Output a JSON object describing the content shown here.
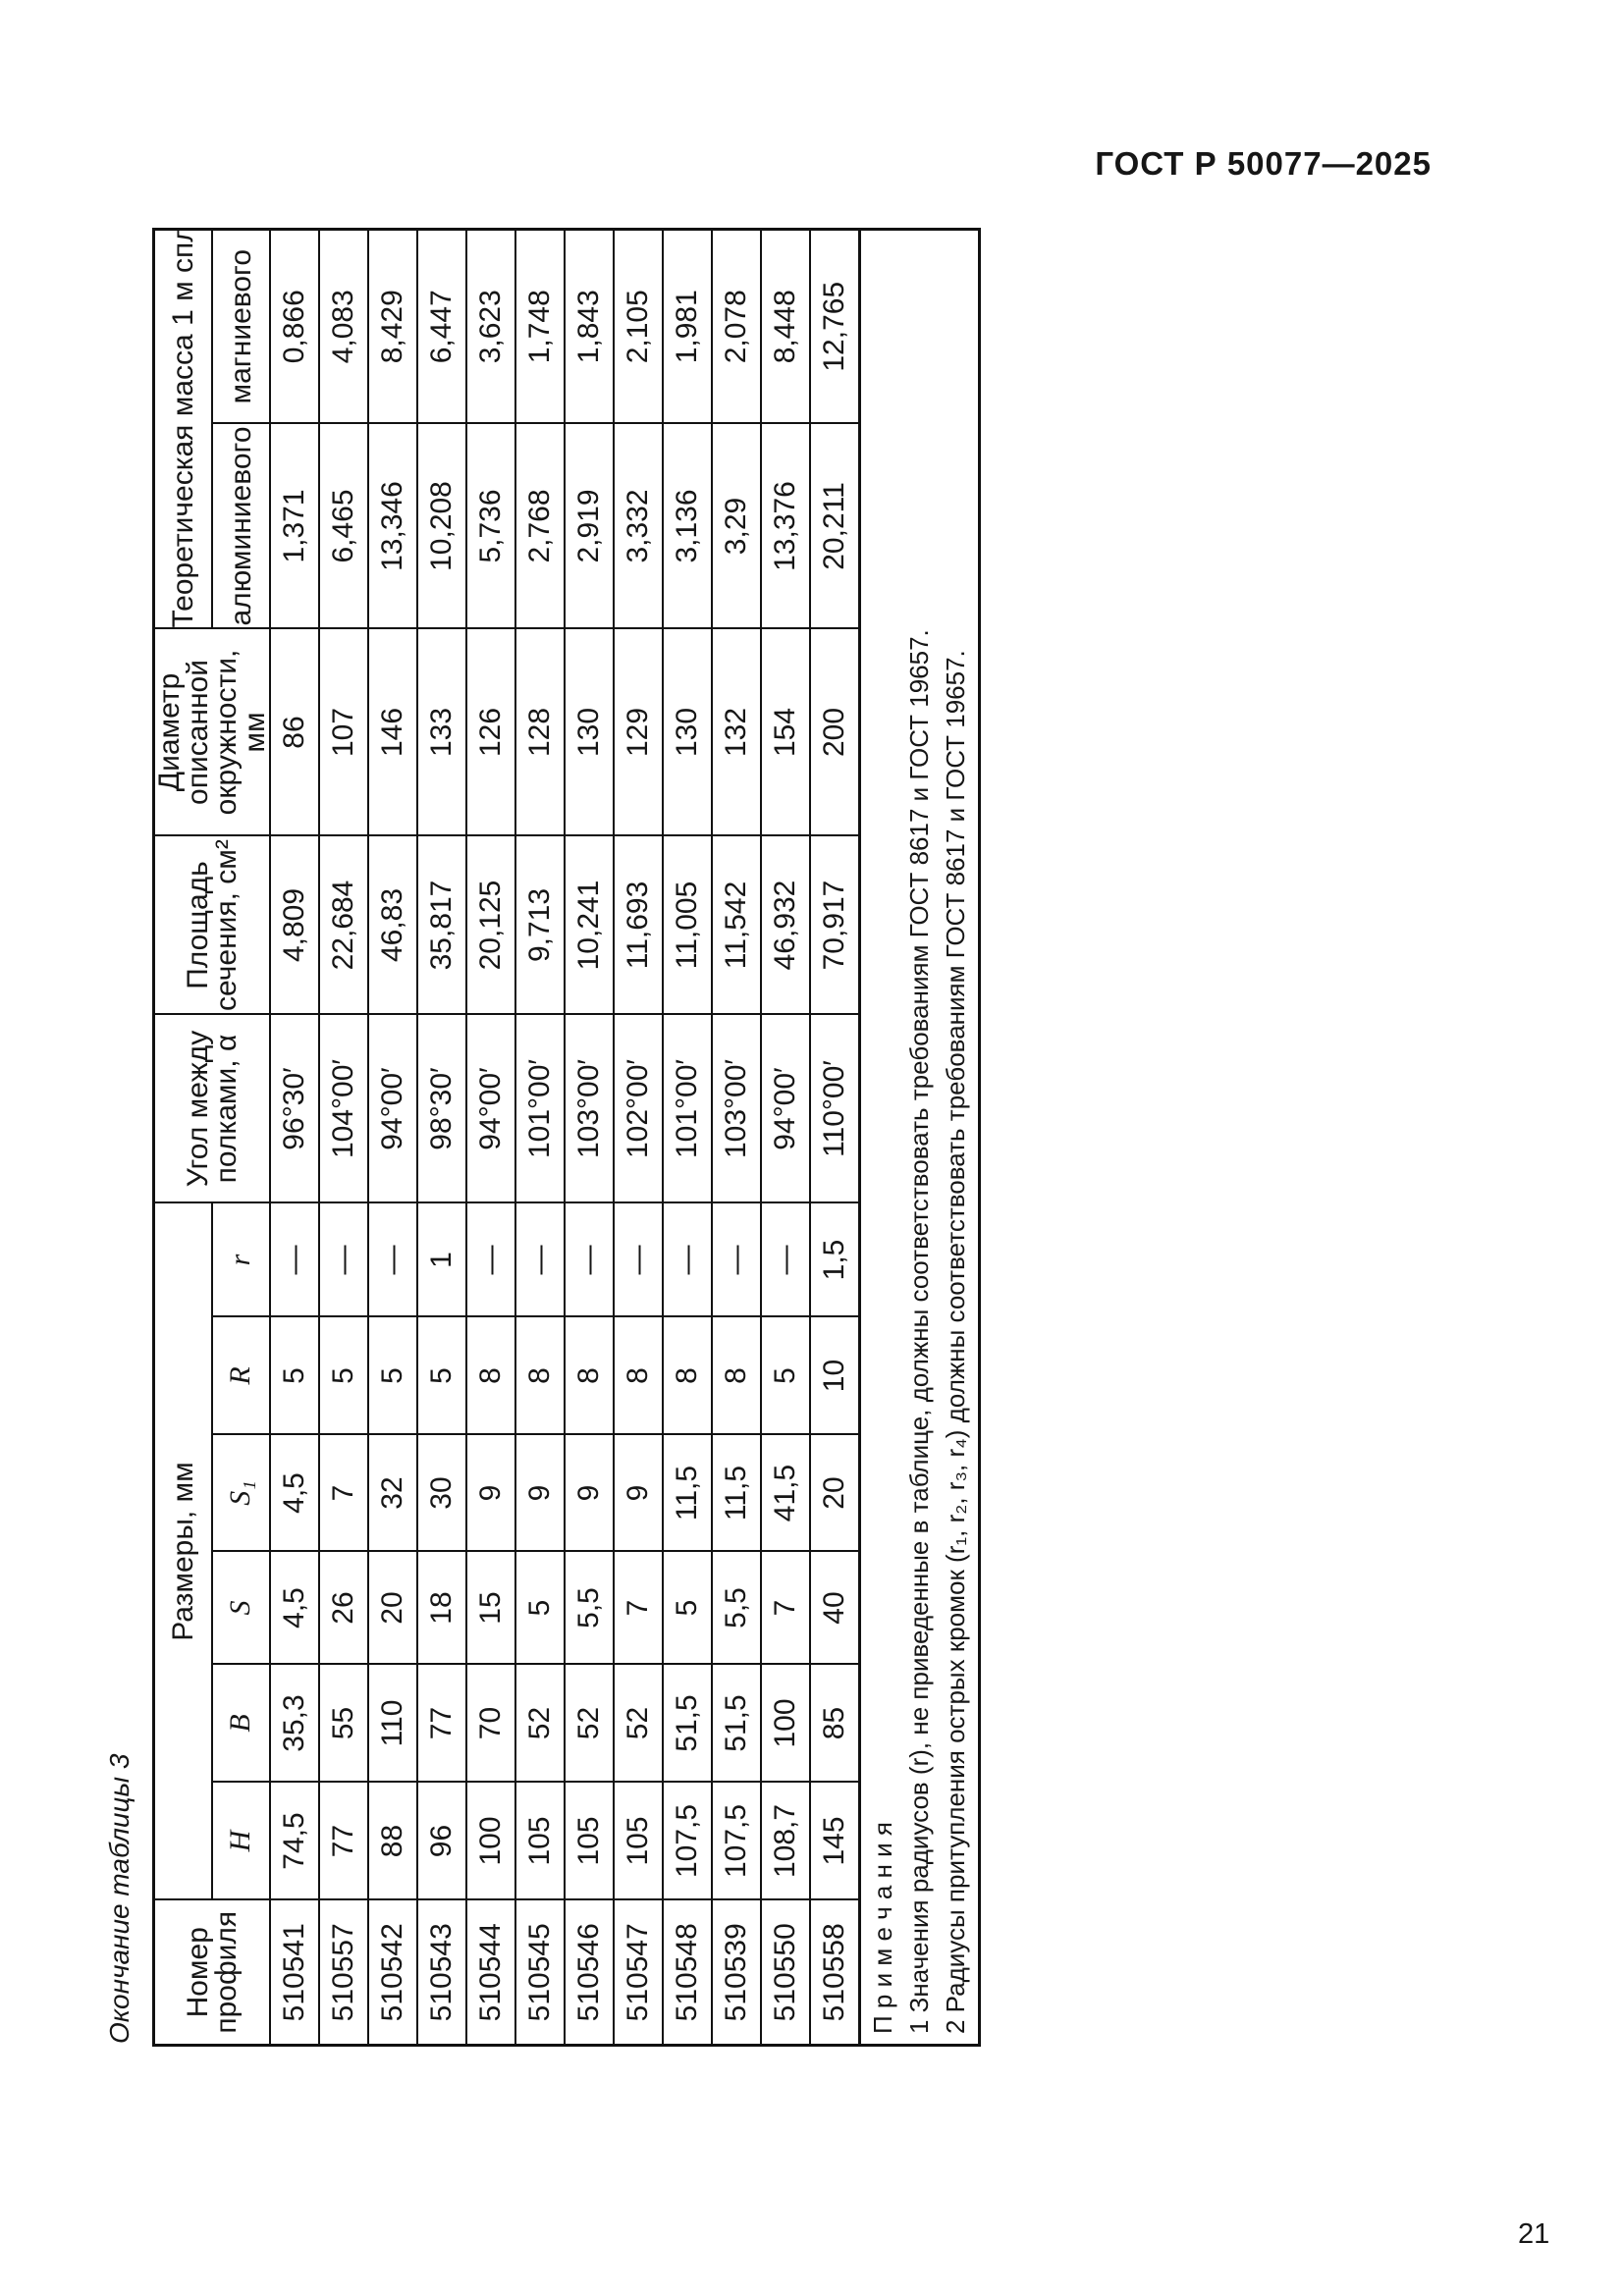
{
  "page": {
    "header": "ГОСТ Р 50077—2025",
    "page_number": "21",
    "table_caption": "Окончание таблицы 3"
  },
  "table": {
    "header": {
      "profile": "Номер профиля",
      "dimensions_group": "Размеры, мм",
      "dims": [
        "H",
        "B",
        "S",
        "S₁",
        "R",
        "r"
      ],
      "angle": "Угол между полками, α",
      "area": "Площадь сечения, см²",
      "diameter": "Диаметр описанной окружности, мм",
      "mass_group": "Теоретическая масса 1 м сплава, кг",
      "mass_aluminum": "алюминиевого",
      "mass_magnesium": "магниевого"
    },
    "rows": [
      [
        "510541",
        "74,5",
        "35,3",
        "4,5",
        "4,5",
        "5",
        "—",
        "96°30′",
        "4,809",
        "86",
        "1,371",
        "0,866"
      ],
      [
        "510557",
        "77",
        "55",
        "26",
        "7",
        "5",
        "—",
        "104°00′",
        "22,684",
        "107",
        "6,465",
        "4,083"
      ],
      [
        "510542",
        "88",
        "110",
        "20",
        "32",
        "5",
        "—",
        "94°00′",
        "46,83",
        "146",
        "13,346",
        "8,429"
      ],
      [
        "510543",
        "96",
        "77",
        "18",
        "30",
        "5",
        "1",
        "98°30′",
        "35,817",
        "133",
        "10,208",
        "6,447"
      ],
      [
        "510544",
        "100",
        "70",
        "15",
        "9",
        "8",
        "—",
        "94°00′",
        "20,125",
        "126",
        "5,736",
        "3,623"
      ],
      [
        "510545",
        "105",
        "52",
        "5",
        "9",
        "8",
        "—",
        "101°00′",
        "9,713",
        "128",
        "2,768",
        "1,748"
      ],
      [
        "510546",
        "105",
        "52",
        "5,5",
        "9",
        "8",
        "—",
        "103°00′",
        "10,241",
        "130",
        "2,919",
        "1,843"
      ],
      [
        "510547",
        "105",
        "52",
        "7",
        "9",
        "8",
        "—",
        "102°00′",
        "11,693",
        "129",
        "3,332",
        "2,105"
      ],
      [
        "510548",
        "107,5",
        "51,5",
        "5",
        "11,5",
        "8",
        "—",
        "101°00′",
        "11,005",
        "130",
        "3,136",
        "1,981"
      ],
      [
        "510539",
        "107,5",
        "51,5",
        "5,5",
        "11,5",
        "8",
        "—",
        "103°00′",
        "11,542",
        "132",
        "3,29",
        "2,078"
      ],
      [
        "510550",
        "108,7",
        "100",
        "7",
        "41,5",
        "5",
        "—",
        "94°00′",
        "46,932",
        "154",
        "13,376",
        "8,448"
      ],
      [
        "510558",
        "145",
        "85",
        "40",
        "20",
        "10",
        "1,5",
        "110°00′",
        "70,917",
        "200",
        "20,211",
        "12,765"
      ]
    ],
    "notes": [
      "П р и м е ч а н и я",
      "1 Значения радиусов (r), не приведенные в таблице, должны соответствовать требованиям ГОСТ 8617 и ГОСТ 19657.",
      "2 Радиусы притупления острых кромок (r₁, r₂, r₃, r₄) должны соответствовать требованиям ГОСТ 8617 и ГОСТ 19657."
    ]
  }
}
